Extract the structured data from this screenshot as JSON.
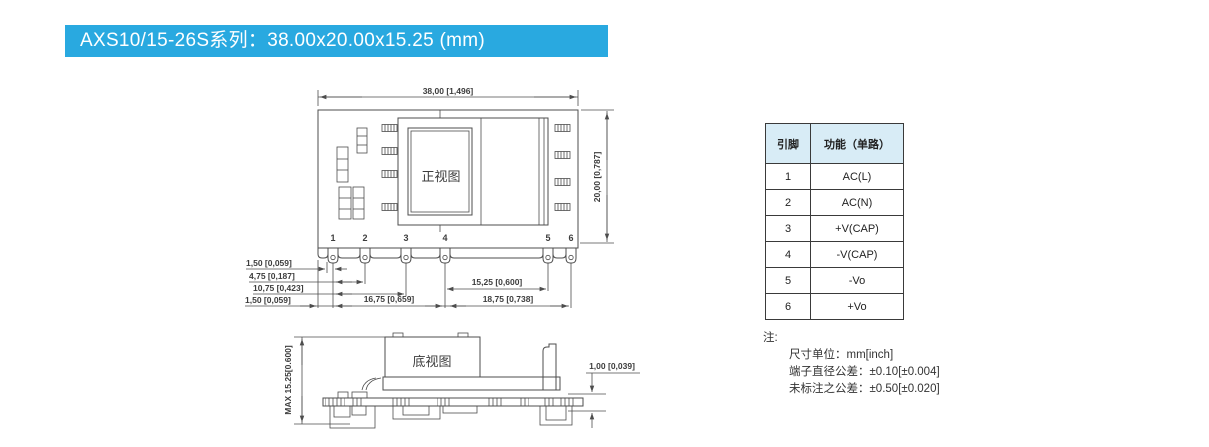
{
  "banner": {
    "title": "AXS10/15-26S系列：38.00x20.00x15.25 (mm)"
  },
  "front_view": {
    "label": "正视图",
    "dim_width": "38,00 [1,496]",
    "dim_height": "20,00 [0,787]",
    "pin_numbers": [
      "1",
      "2",
      "3",
      "4",
      "5",
      "6"
    ],
    "dim_pin1_offset": "1,50 [0,059]",
    "dim_pin2_span": "4,75 [0,187]",
    "dim_pin3_span": "10,75 [0,423]",
    "dim_edge_offset": "1,50 [0,059]",
    "dim_pin4_span": "16,75 [0,659]",
    "dim_pin5_span": "15,25 [0,600]",
    "dim_pin6_span": "18,75 [0,738]"
  },
  "bottom_view": {
    "label": "底视图",
    "dim_max_height": "MAX 15.25[0.600]",
    "dim_standoff": "1,00 [0,039]"
  },
  "pin_table": {
    "header_pin": "引脚",
    "header_function": "功能（单路）",
    "rows": [
      {
        "pin": "1",
        "function": "AC(L)"
      },
      {
        "pin": "2",
        "function": "AC(N)"
      },
      {
        "pin": "3",
        "function": "+V(CAP)"
      },
      {
        "pin": "4",
        "function": "-V(CAP)"
      },
      {
        "pin": "5",
        "function": "-Vo"
      },
      {
        "pin": "6",
        "function": "+Vo"
      }
    ]
  },
  "notes": {
    "label": "注:",
    "line1": "尺寸单位：mm[inch]",
    "line2": "端子直径公差：±0.10[±0.004]",
    "line3": "未标注之公差：±0.50[±0.020]"
  },
  "colors": {
    "banner_bg": "#29A9E0",
    "table_header_bg": "#D8ECF6",
    "line": "#4D4D4D"
  }
}
